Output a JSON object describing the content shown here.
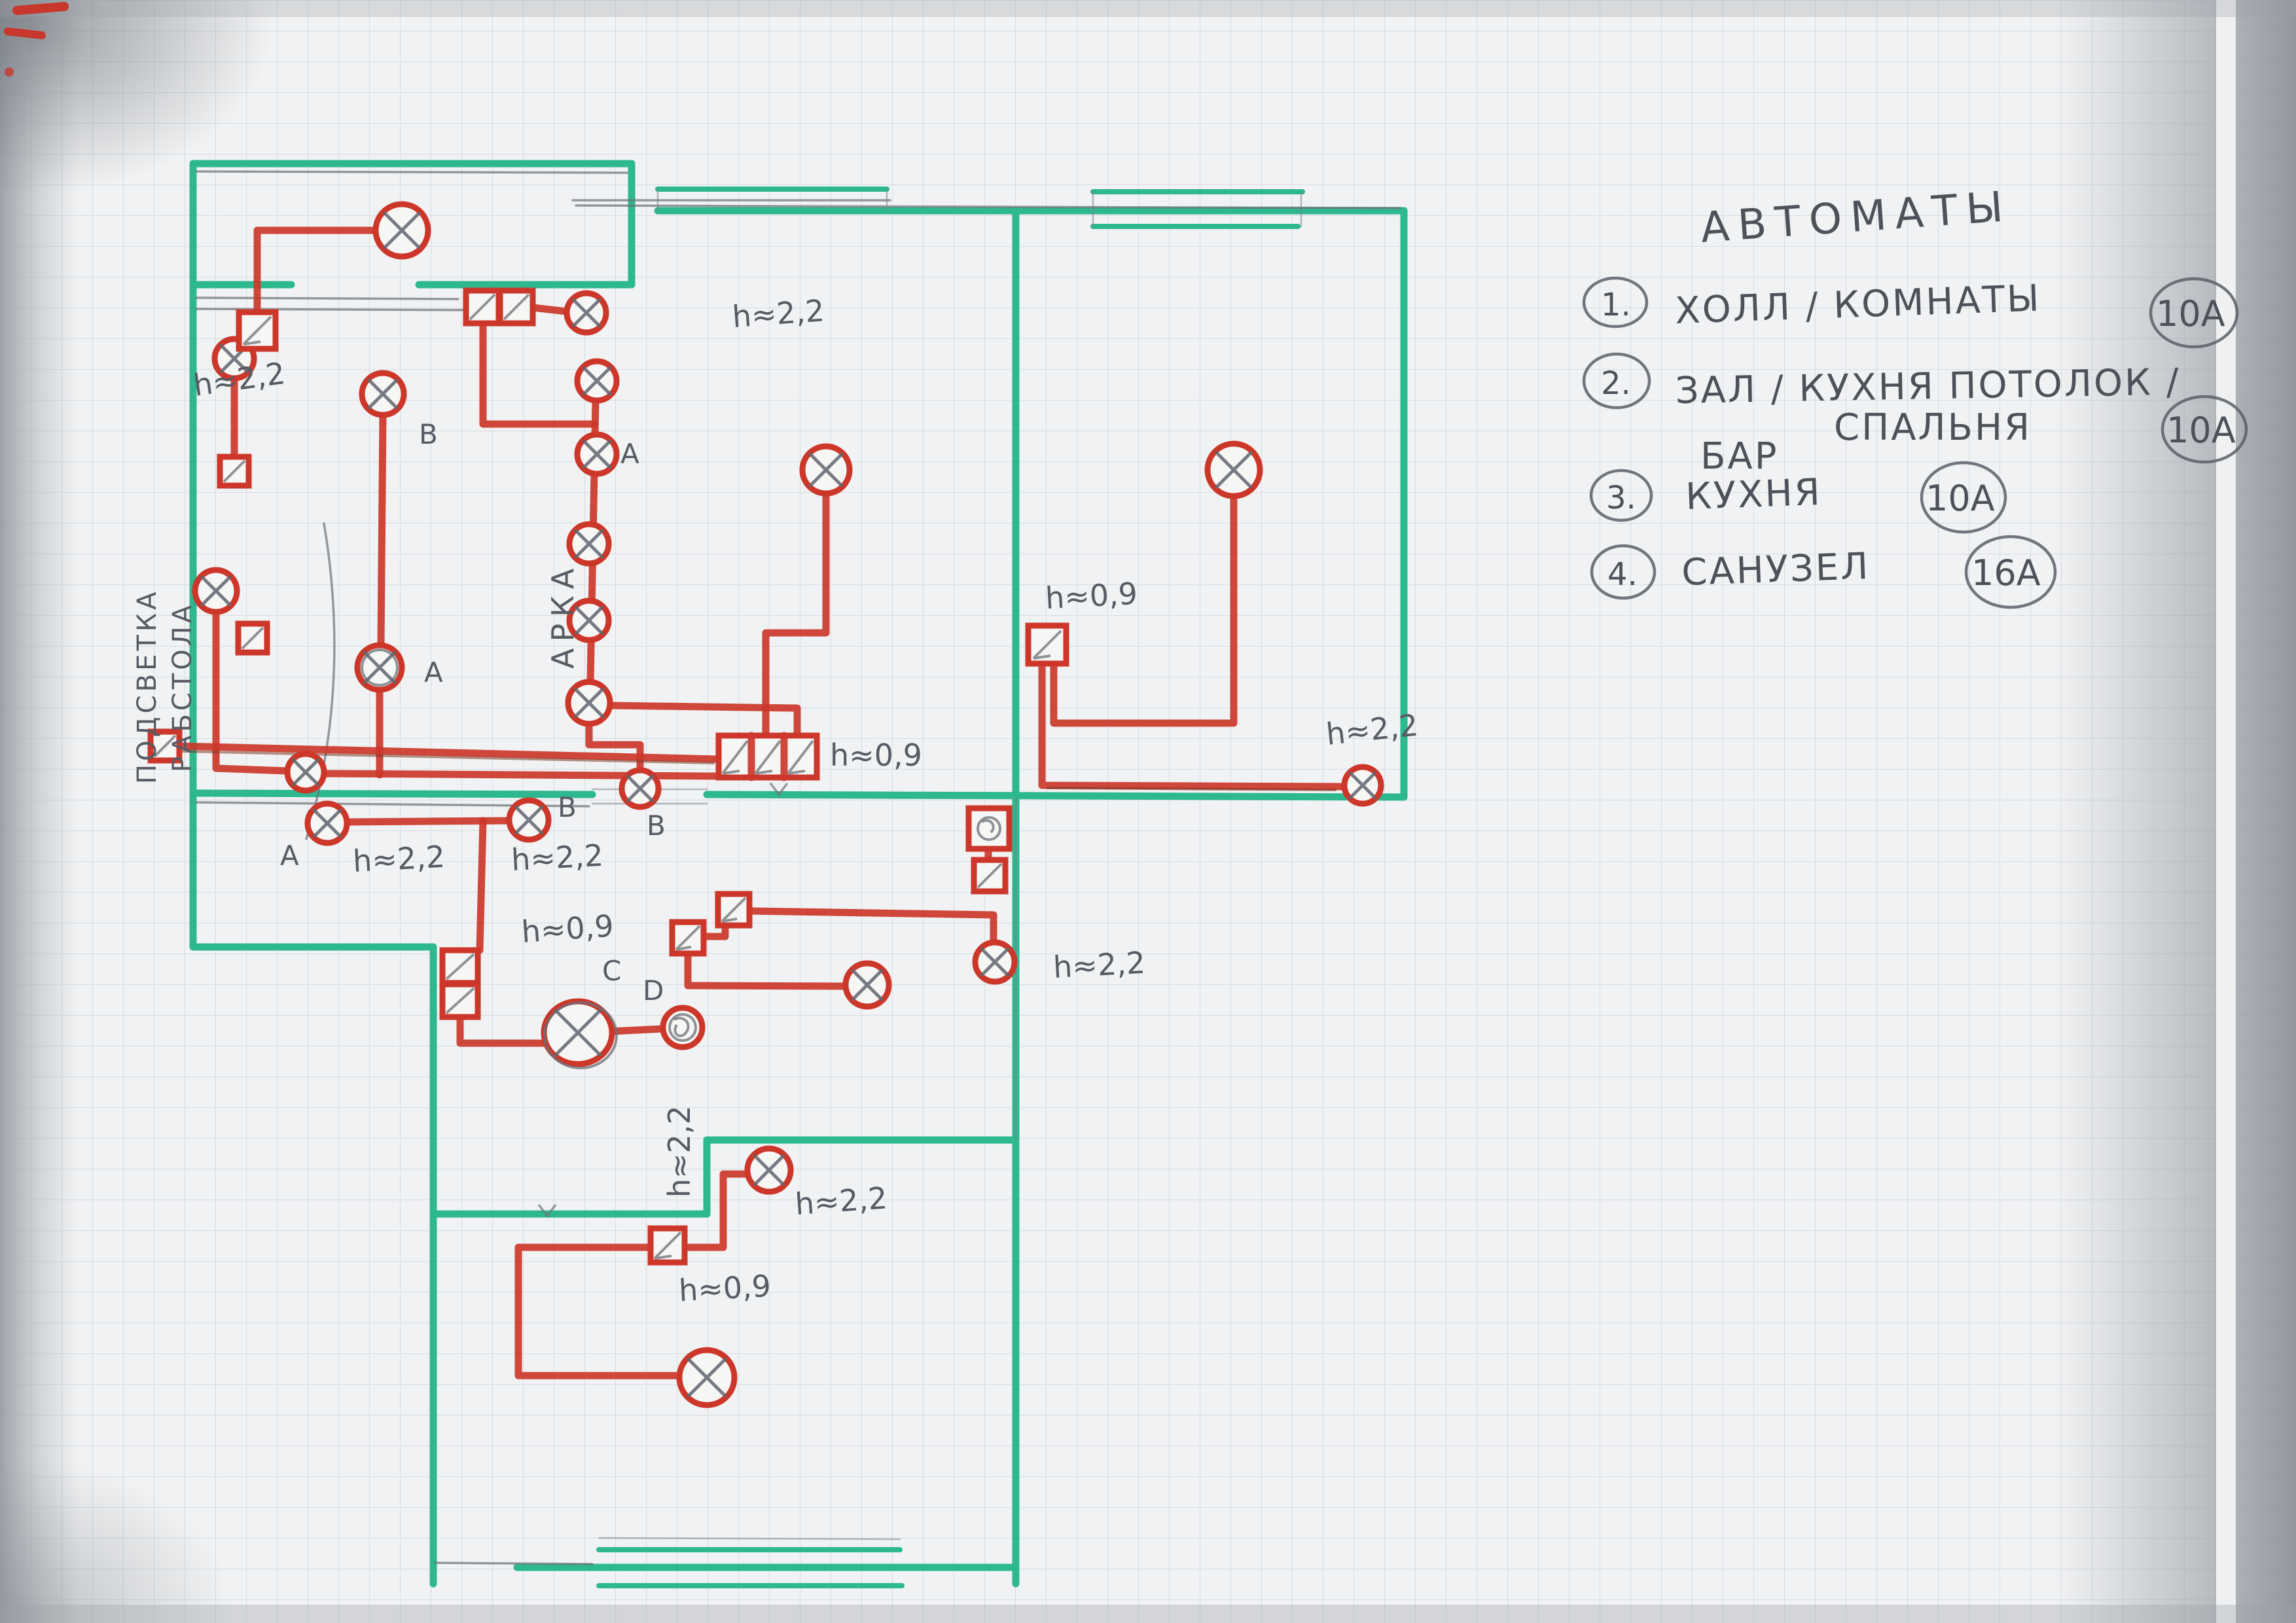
{
  "document_type": "hand-drawn apartment electrical wiring plan (scan)",
  "colors": {
    "wall_marker": "#2db890",
    "wire_marker": "#cc372a",
    "pencil": "#6b7078",
    "paper": "#f1f2f3"
  },
  "legend": {
    "title": "АВТОМАТЫ",
    "items": [
      {
        "num": "1.",
        "label": "ХОЛЛ / КОМНАТЫ",
        "amp": "10А"
      },
      {
        "num": "2.",
        "label": "ЗАЛ / КУХНЯ ПОТОЛОК /",
        "label2": "СПАЛЬНЯ",
        "amp": "10А"
      },
      {
        "num": "3.",
        "pre": "БАР",
        "label": "КУХНЯ",
        "amp": "10А"
      },
      {
        "num": "4.",
        "label": "САНУЗЕЛ",
        "amp": "16А"
      }
    ]
  },
  "labels": {
    "h22": "h≈2,2",
    "h09": "h≈0,9",
    "letter_a": "A",
    "letter_b": "B",
    "letter_c": "C",
    "letter_d": "D",
    "podsvetka": "ПОДСВЕТКА",
    "rabstola": "РАБСТОЛА",
    "arka": "АРКА"
  }
}
